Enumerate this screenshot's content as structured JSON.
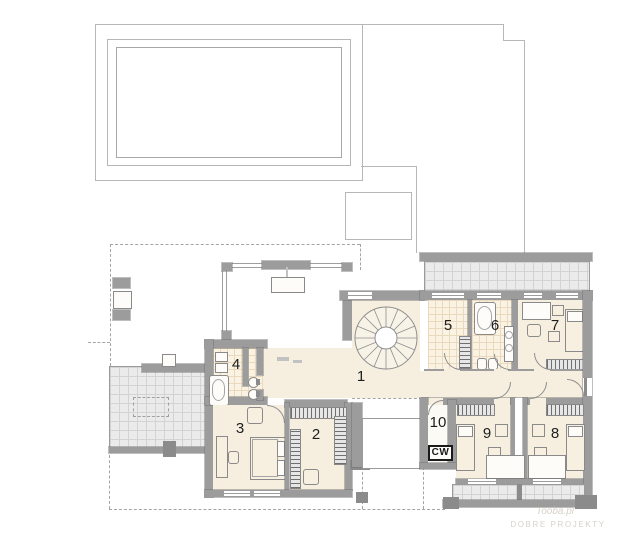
{
  "plan": {
    "room_labels": {
      "r1": "1",
      "r2": "2",
      "r3": "3",
      "r4": "4",
      "r5": "5",
      "r6": "6",
      "r7": "7",
      "r8": "8",
      "r9": "9",
      "r10": "10"
    },
    "tags": {
      "cw": "CW"
    },
    "watermark": {
      "line1": "Tooba.pl",
      "line2": "DOBRE PROJEKTY"
    },
    "colors": {
      "wall_gray": "#9c9c9c",
      "floor_cream": "#f6efe0",
      "bath_tile": "#faf3e4",
      "terrace_gray": "#ebebeb",
      "line_gray": "#b7b7b7",
      "label_black": "#1d1d1d"
    }
  }
}
